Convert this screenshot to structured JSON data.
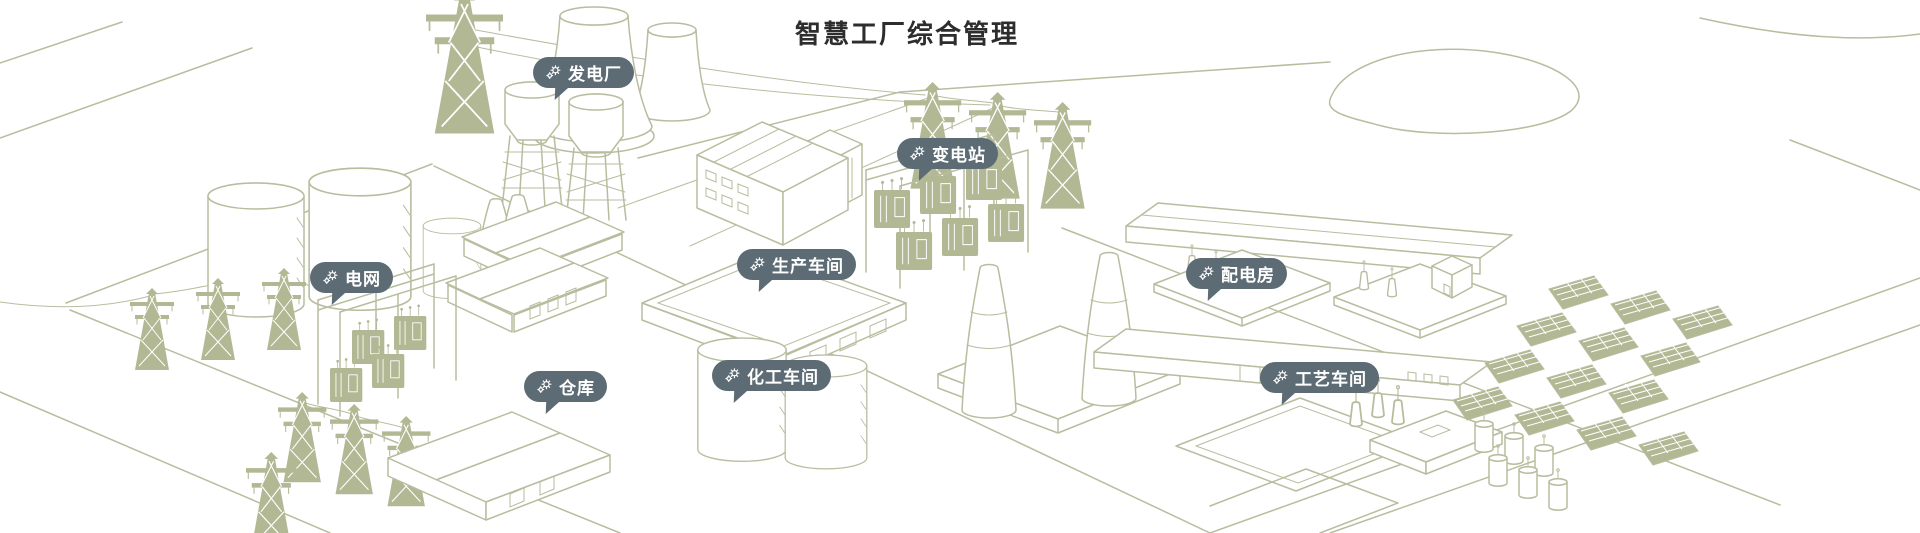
{
  "title": "智慧工厂综合管理",
  "theme": {
    "marker_bg": "#5c6b74",
    "marker_text": "#ffffff",
    "title_color": "#2d2d2d",
    "line_art": "#b7bd9e",
    "line_art_fill": "#b2b894",
    "background": "#ffffff"
  },
  "markers": [
    {
      "id": "power-plant",
      "label": "发电厂",
      "icon": "gears-icon"
    },
    {
      "id": "substation",
      "label": "变电站",
      "icon": "gears-icon"
    },
    {
      "id": "power-grid",
      "label": "电网",
      "icon": "gears-icon"
    },
    {
      "id": "production-workshop",
      "label": "生产车间",
      "icon": "gears-icon"
    },
    {
      "id": "distribution-room",
      "label": "配电房",
      "icon": "gears-icon"
    },
    {
      "id": "warehouse",
      "label": "仓库",
      "icon": "gears-icon"
    },
    {
      "id": "chemical-workshop",
      "label": "化工车间",
      "icon": "gears-icon"
    },
    {
      "id": "process-workshop",
      "label": "工艺车间",
      "icon": "gears-icon"
    }
  ]
}
